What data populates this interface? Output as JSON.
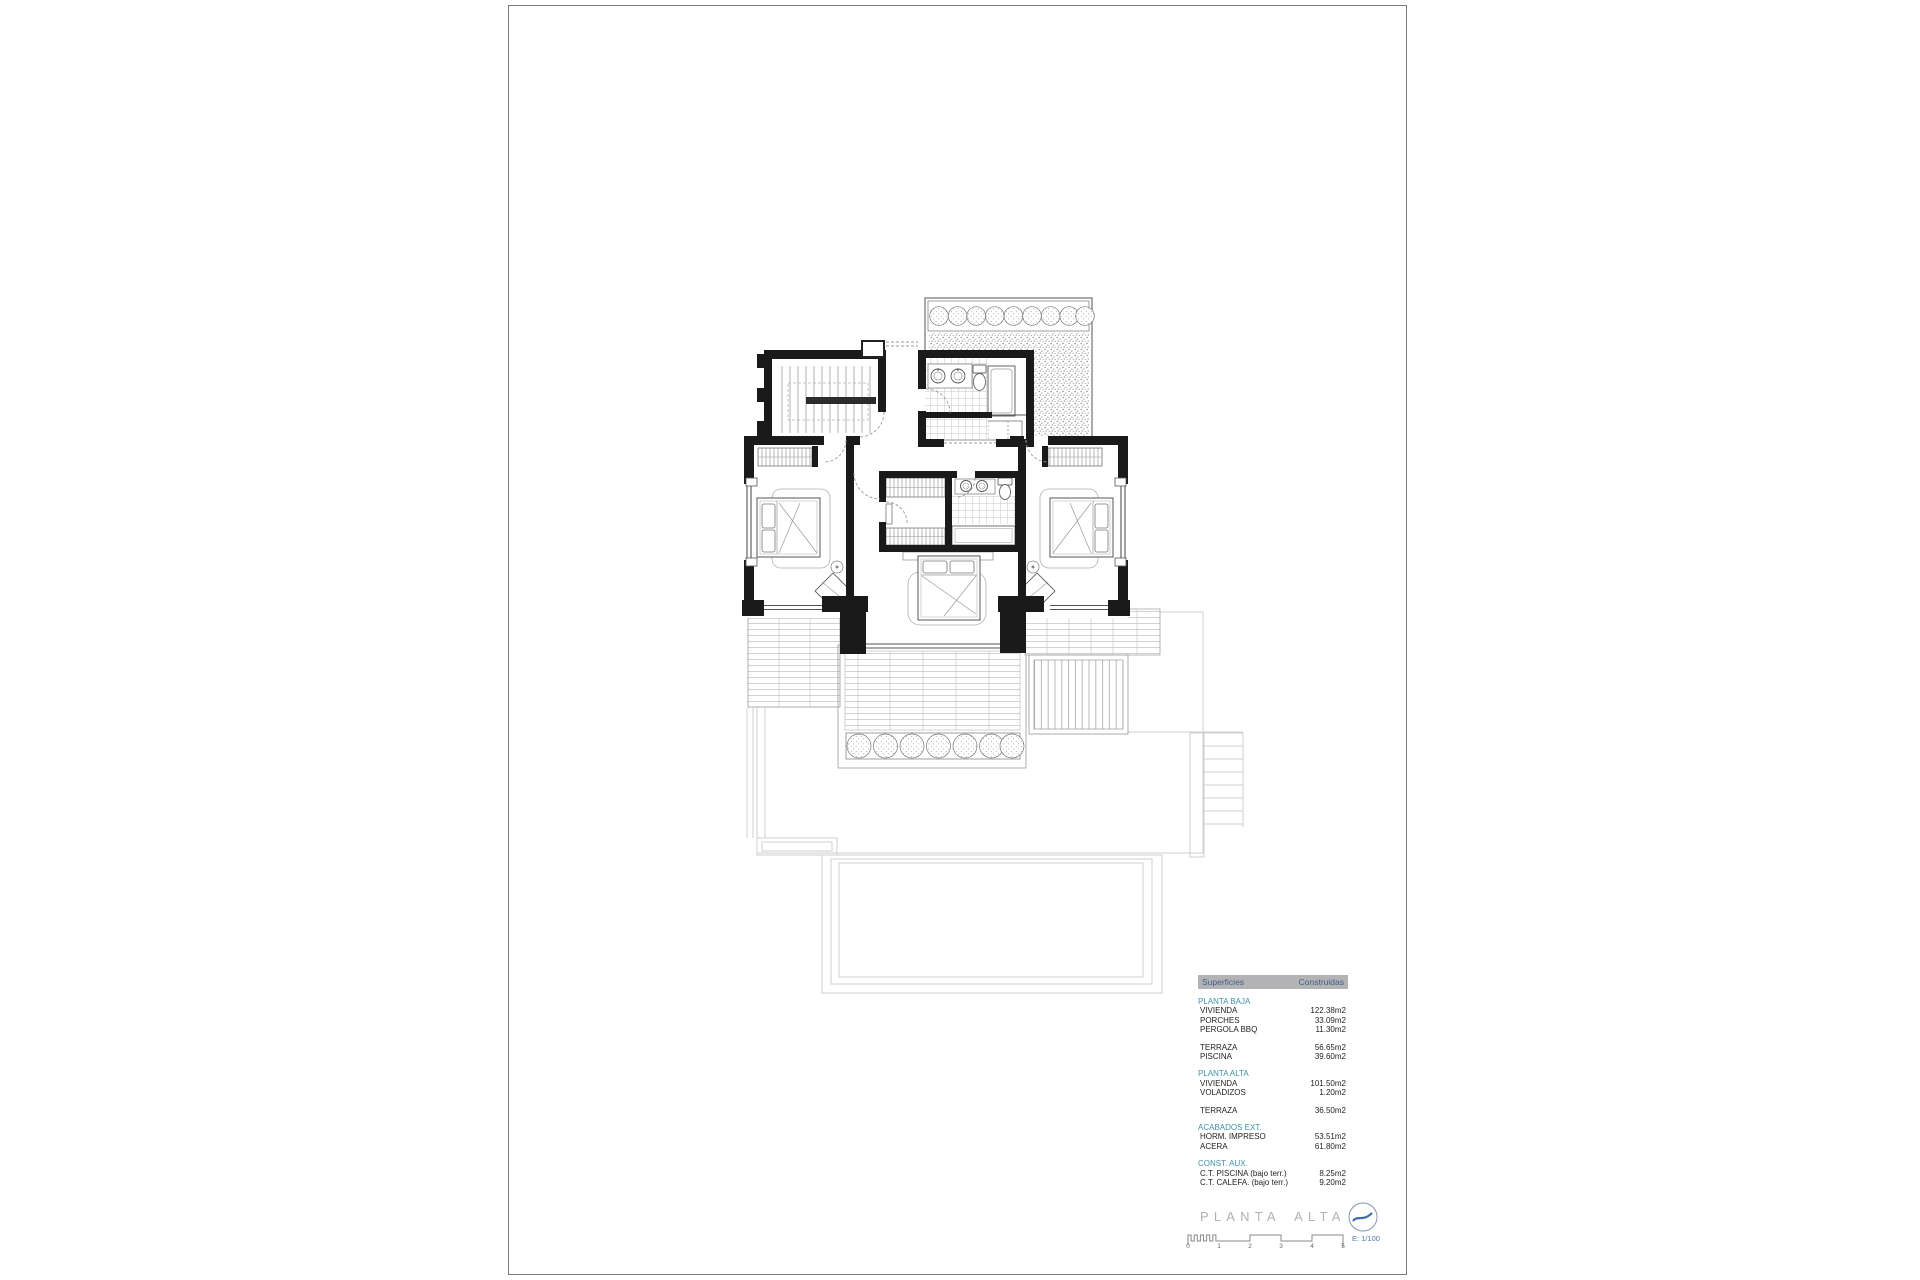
{
  "surfaces_table": {
    "header": {
      "surfaces": "Superficies",
      "built": "Construidas"
    },
    "sections": [
      {
        "heading": "PLANTA BAJA",
        "rows": [
          {
            "label": "VIVIENDA",
            "value": "122.38m2"
          },
          {
            "label": "PORCHES",
            "value": "33.09m2"
          },
          {
            "label": "PERGOLA BBQ",
            "value": "11.30m2"
          }
        ]
      },
      {
        "heading": "",
        "rows": [
          {
            "label": "TERRAZA",
            "value": "56.65m2"
          },
          {
            "label": "PISCINA",
            "value": "39.60m2"
          }
        ]
      },
      {
        "heading": "PLANTA ALTA",
        "rows": [
          {
            "label": "VIVIENDA",
            "value": "101.50m2"
          },
          {
            "label": "VOLADIZOS",
            "value": "1.20m2"
          }
        ]
      },
      {
        "heading": "",
        "rows": [
          {
            "label": "TERRAZA",
            "value": "36.50m2"
          }
        ]
      },
      {
        "heading": "ACABADOS EXT.",
        "rows": [
          {
            "label": "HORM. IMPRESO",
            "value": "53.51m2"
          },
          {
            "label": "ACERA",
            "value": "61.80m2"
          }
        ]
      },
      {
        "heading": "CONST. AUX.",
        "rows": [
          {
            "label": "C.T. PISCINA (bajo terr.)",
            "value": "8.25m2"
          },
          {
            "label": "C.T. CALEFA. (bajo terr.)",
            "value": "9.20m2"
          }
        ]
      }
    ]
  },
  "sheet": {
    "title": "PLANTA ALTA",
    "scale_text": "E: 1/100",
    "scale_numbers": [
      "0",
      "1",
      "2",
      "3",
      "4",
      "5"
    ]
  },
  "colors": {
    "section_heading": "#3e93a8",
    "table_header_text": "#3d5f87",
    "table_header_bg": "#b3b3b6",
    "title_gray": "#b2b2b2",
    "scale_text_blue": "#4a78a8",
    "wall_black": "#1a1a1a",
    "ghost_gray": "#cfcfcf"
  }
}
